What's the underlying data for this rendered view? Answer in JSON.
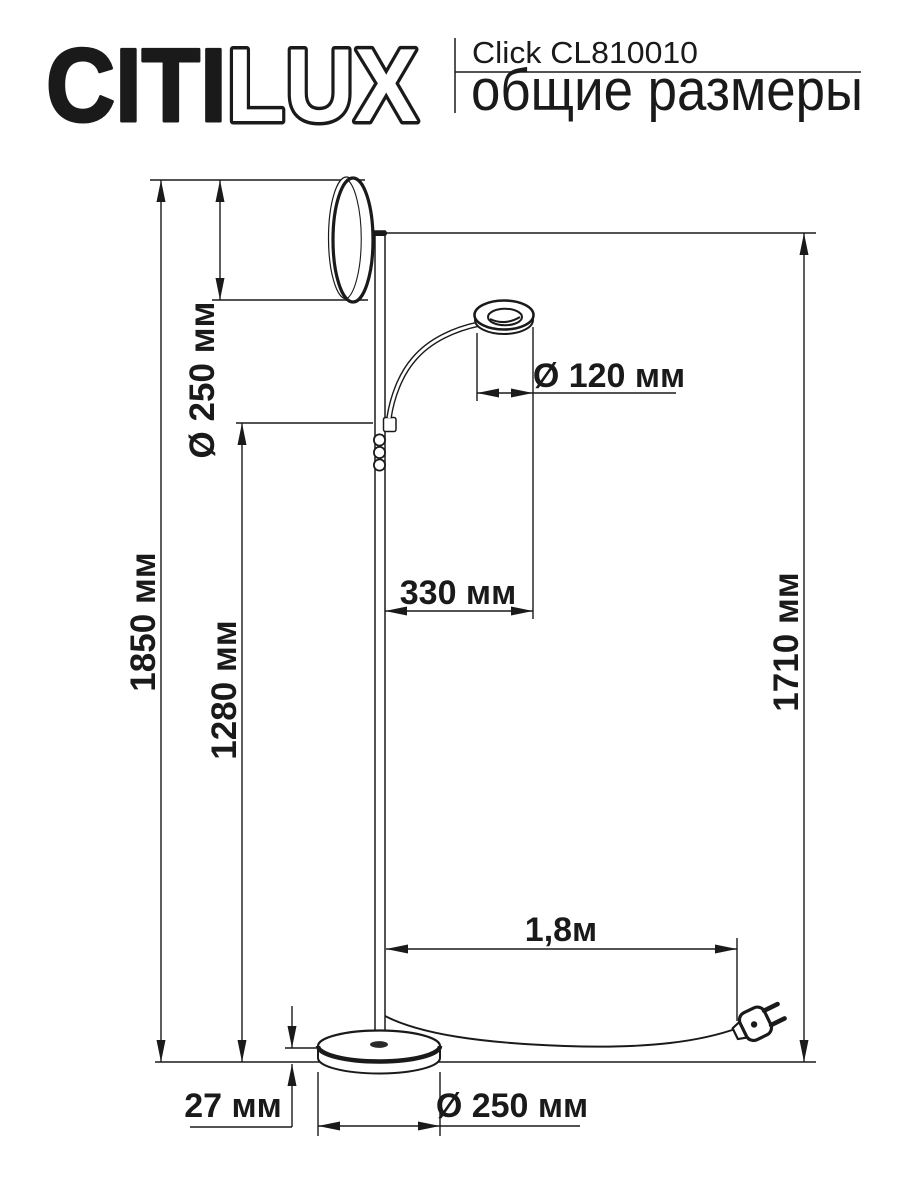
{
  "header": {
    "brand": {
      "citi": "CITI",
      "lux": "LUX"
    },
    "product": "Click CL810010",
    "subtitle": "общие размеры"
  },
  "diagram": {
    "dimensions": {
      "head_diameter": "Ø 250 мм",
      "total_height": "1850 мм",
      "arm_height": "1280 мм",
      "pole_height": "1710 мм",
      "reading_head_diameter": "Ø 120 мм",
      "arm_reach": "330 мм",
      "cable_length": "1,8м",
      "base_height": "27 мм",
      "base_diameter": "Ø 250 мм"
    },
    "colors": {
      "line": "#1a1a1a",
      "background": "#ffffff"
    }
  }
}
